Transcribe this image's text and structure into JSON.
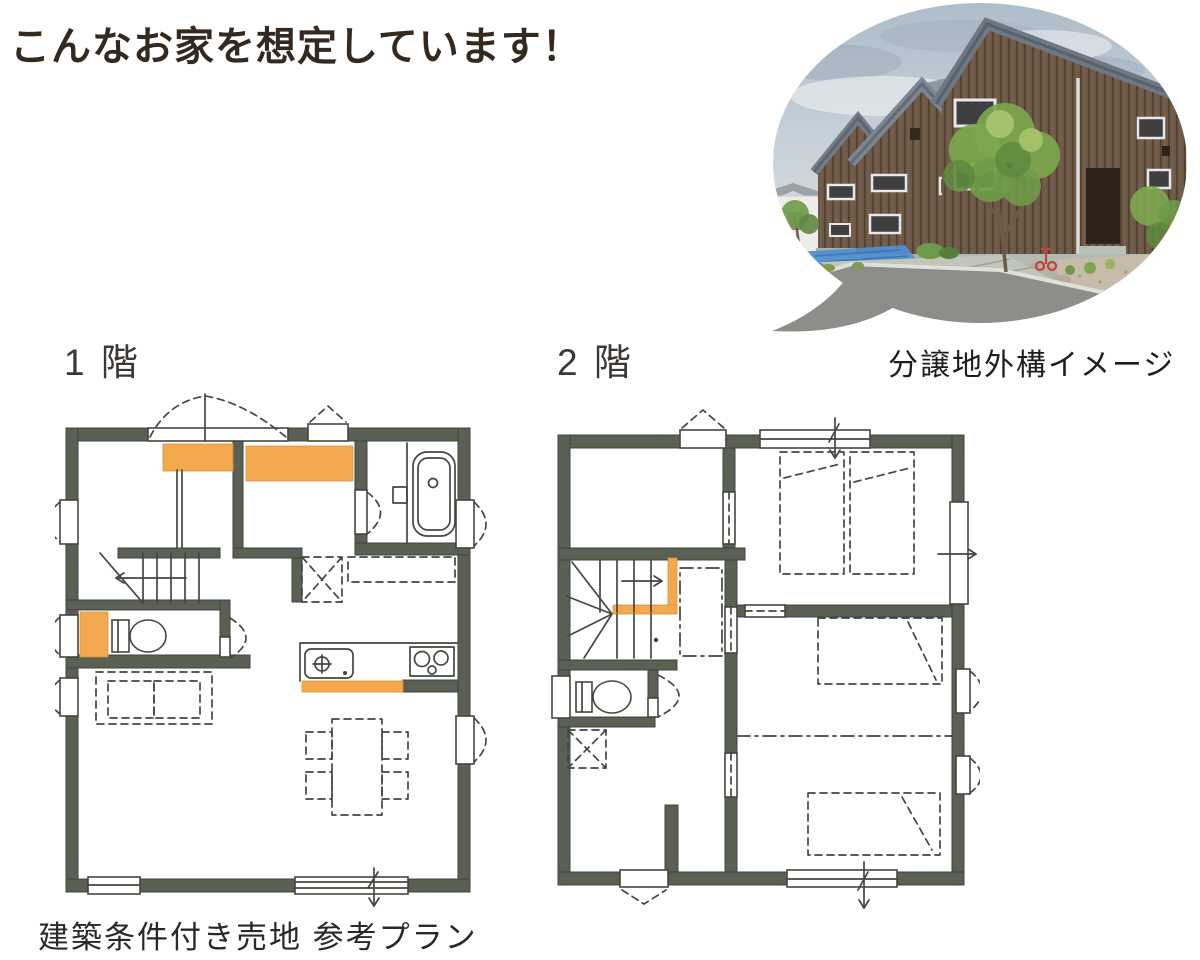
{
  "theme": {
    "background": "#ffffff",
    "title_color": "#33291f",
    "label_color": "#3c3733",
    "wall_color": "#5a6054",
    "accent_orange": "#f3a94e",
    "line_color": "#45463f",
    "sky_top": "#aebdca",
    "sky_bottom": "#dde2e4",
    "wood": "#6e5948",
    "wood_dark": "#52402f",
    "roof": "#8d98a2",
    "tree_green": "#7da74e",
    "tree_dark": "#5f8a3e",
    "road": "#8d8d8a",
    "concrete": "#c2c5ba",
    "tarp_blue": "#4f8fd2"
  },
  "header": {
    "title": "こんなお家を想定しています！"
  },
  "photo": {
    "caption": "分譲地外構イメージ"
  },
  "floor_plans": {
    "first": {
      "label": "1 階"
    },
    "second": {
      "label": "2 階"
    }
  },
  "footer": {
    "caption": "建築条件付き売地 参考プラン"
  }
}
